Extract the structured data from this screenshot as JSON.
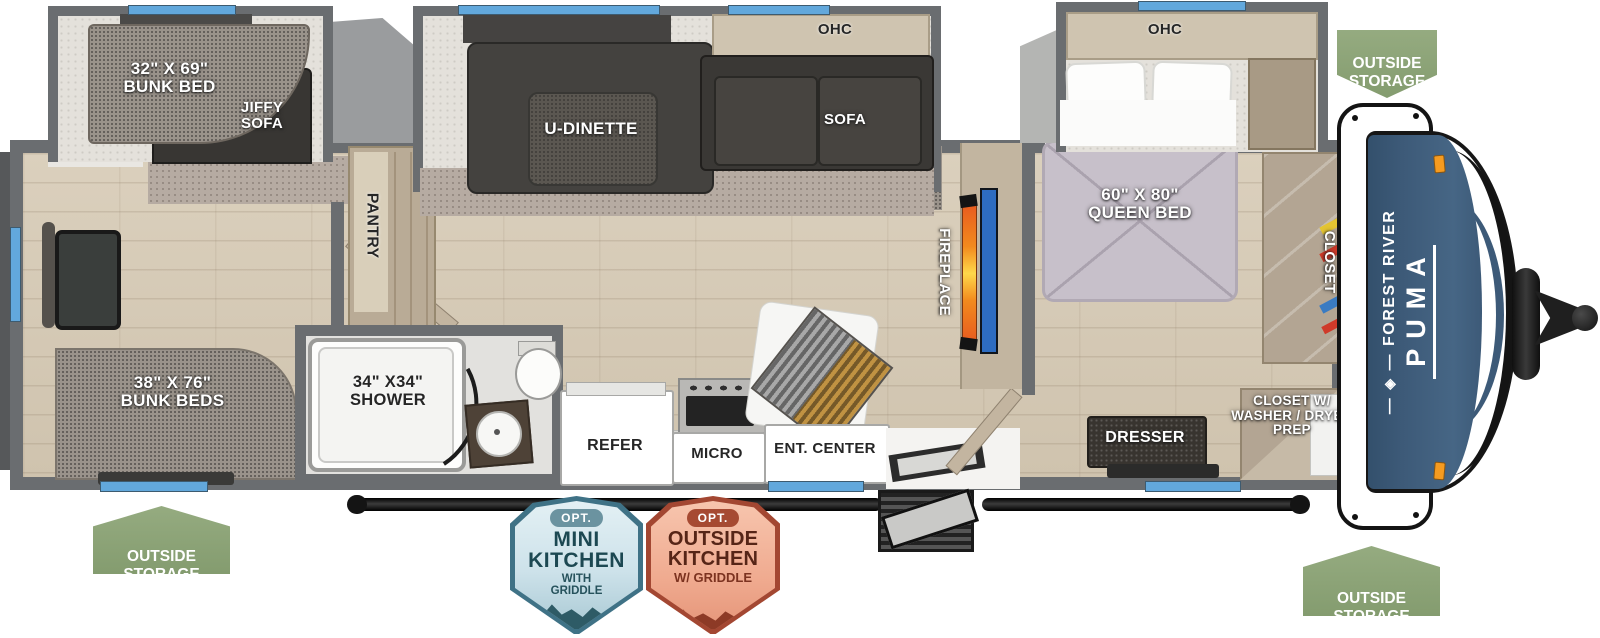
{
  "floorplan": {
    "brand": {
      "name": "FOREST RIVER",
      "model": "PUMA"
    },
    "rear_slide": {
      "bunk_bed": "32\" X 69\"\nBUNK BED",
      "jiffy_sofa": "JIFFY\nSOFA"
    },
    "rear_room": {
      "bunk_beds": "38\" X 76\"\nBUNK BEDS"
    },
    "bathroom": {
      "shower": "34\" X34\"\nSHOWER"
    },
    "pantry": "PANTRY",
    "main_slide": {
      "dinette": "U-DINETTE",
      "ohc": "OHC",
      "sofa": "SOFA"
    },
    "kitchen": {
      "refer": "REFER",
      "micro": "MICRO",
      "ent_center": "ENT. CENTER"
    },
    "fireplace": "FIREPLACE",
    "bedroom": {
      "ohc": "OHC",
      "queen_bed": "60\" X 80\"\nQUEEN BED",
      "closet": "CLOSET",
      "dresser": "DRESSER",
      "closet_wd": "CLOSET W/\nWASHER / DRYER\nPREP"
    }
  },
  "badges": {
    "outside_storage": "OUTSIDE\nSTORAGE",
    "mini_kitchen": {
      "opt": "OPT.",
      "title": "MINI\nKITCHEN",
      "sub": "WITH\nGRIDDLE"
    },
    "outside_kitchen": {
      "opt": "OPT.",
      "title": "OUTSIDE\nKITCHEN",
      "sub": "W/ GRIDDLE"
    }
  },
  "colors": {
    "wall": "#6a6d70",
    "window_blue": "#62a8dc",
    "badge_green": "#8ba377",
    "cap_blue": "#3d5a78",
    "fireplace_orange": "#f28a1e",
    "tv_blue": "#2e6cc0",
    "marker_orange": "#f59b20"
  }
}
